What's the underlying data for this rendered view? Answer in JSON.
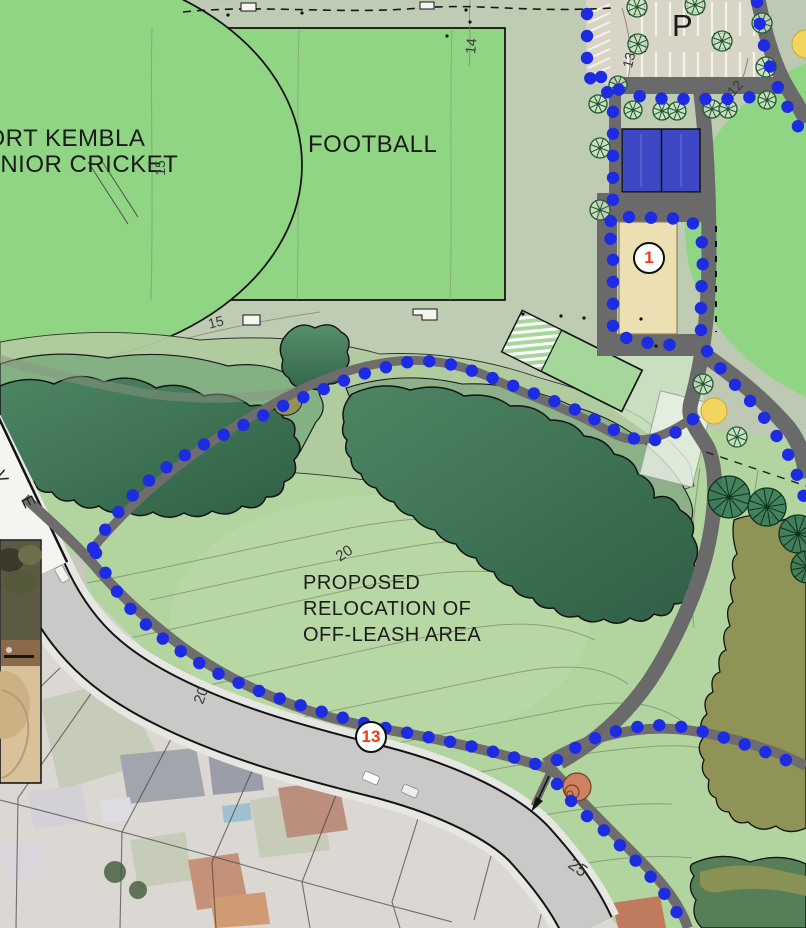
{
  "labels": {
    "oval_label": "PORT KEMBLA\nJUNIOR CRICKET",
    "field_label": "FOOTBALL",
    "parking_label": "P",
    "annotation": "PROPOSED\nRELOCATION OF\nOFF-LEASH AREA"
  },
  "markers": [
    {
      "number": "1",
      "x": 649,
      "y": 258
    },
    {
      "number": "13",
      "x": 371,
      "y": 737
    }
  ],
  "contour_labels": [
    {
      "t": "15",
      "x": 152,
      "y": 160,
      "r": -90,
      "s": 14
    },
    {
      "t": "15",
      "x": 208,
      "y": 314,
      "r": -14,
      "s": 14
    },
    {
      "t": "14",
      "x": 463,
      "y": 38,
      "r": -84,
      "s": 14
    },
    {
      "t": "13",
      "x": 621,
      "y": 52,
      "r": -76,
      "s": 14
    },
    {
      "t": "12",
      "x": 727,
      "y": 80,
      "r": -48,
      "s": 14
    },
    {
      "t": "20",
      "x": 336,
      "y": 545,
      "r": -33,
      "s": 15
    },
    {
      "t": "20",
      "x": 193,
      "y": 687,
      "r": -70,
      "s": 15
    },
    {
      "t": "25",
      "x": 568,
      "y": 858,
      "r": 35,
      "s": 17
    }
  ],
  "street_name_letters": [
    {
      "t": "V",
      "x": -5,
      "y": 467,
      "r": 64
    },
    {
      "t": "E",
      "x": 22,
      "y": 492,
      "r": 64
    }
  ],
  "colors": {
    "route_dot": "#1d2be3",
    "marker_number": "#f23a10",
    "court_blue": "#3f48c4",
    "building_tan": "#ecdfb2",
    "field_green": "#8fd584",
    "path_grey": "#6a6a6a",
    "canopy_dark": "#3c7354",
    "olive": "#8f9355",
    "yellow_feature": "#f1d55c",
    "terracotta_feature": "#cd8261"
  },
  "route": {
    "dot_spacing": 22,
    "dot_radius": 6.2,
    "chains": [
      [
        [
          587,
          -8
        ],
        [
          587,
          76
        ],
        [
          601,
          86
        ],
        [
          613,
          98
        ],
        [
          613,
          218
        ],
        [
          604,
          230
        ],
        [
          613,
          242
        ],
        [
          613,
          334
        ],
        [
          640,
          342
        ],
        [
          672,
          345
        ]
      ],
      [
        [
          629,
          217
        ],
        [
          689,
          219
        ],
        [
          701,
          232
        ],
        [
          703,
          258
        ],
        [
          701,
          295
        ],
        [
          701,
          332
        ],
        [
          708,
          354
        ],
        [
          722,
          370
        ],
        [
          737,
          387
        ],
        [
          752,
          403
        ],
        [
          766,
          420
        ],
        [
          778,
          438
        ],
        [
          789,
          456
        ],
        [
          797,
          475
        ],
        [
          803,
          494
        ],
        [
          806,
          503
        ]
      ],
      [
        [
          93,
          548
        ],
        [
          111,
          521
        ],
        [
          131,
          497
        ],
        [
          153,
          477
        ],
        [
          178,
          459
        ],
        [
          205,
          444
        ],
        [
          233,
          430
        ],
        [
          262,
          416
        ],
        [
          291,
          402
        ],
        [
          319,
          391
        ],
        [
          348,
          379
        ],
        [
          378,
          369
        ],
        [
          408,
          362
        ],
        [
          438,
          361
        ],
        [
          467,
          369
        ],
        [
          495,
          379
        ],
        [
          522,
          389
        ],
        [
          549,
          399
        ],
        [
          574,
          409
        ],
        [
          598,
          421
        ],
        [
          621,
          434
        ],
        [
          644,
          442
        ],
        [
          666,
          438
        ],
        [
          685,
          427
        ],
        [
          698,
          414
        ]
      ],
      [
        [
          96,
          553
        ],
        [
          108,
          578
        ],
        [
          124,
          602
        ],
        [
          144,
          623
        ],
        [
          167,
          642
        ],
        [
          192,
          659
        ],
        [
          219,
          674
        ],
        [
          248,
          687
        ],
        [
          278,
          698
        ],
        [
          309,
          708
        ],
        [
          340,
          717
        ],
        [
          372,
          725
        ],
        [
          404,
          732
        ],
        [
          437,
          739
        ],
        [
          470,
          746
        ],
        [
          502,
          754
        ],
        [
          530,
          762
        ],
        [
          549,
          769
        ]
      ],
      [
        [
          557,
          784
        ],
        [
          572,
          802
        ],
        [
          589,
          818
        ],
        [
          607,
          833
        ],
        [
          625,
          850
        ],
        [
          642,
          867
        ],
        [
          658,
          885
        ],
        [
          671,
          903
        ],
        [
          682,
          921
        ],
        [
          687,
          928
        ]
      ],
      [
        [
          557,
          760
        ],
        [
          578,
          746
        ],
        [
          602,
          735
        ],
        [
          628,
          728
        ],
        [
          655,
          725
        ],
        [
          682,
          727
        ],
        [
          709,
          733
        ],
        [
          735,
          741
        ],
        [
          760,
          750
        ],
        [
          783,
          759
        ],
        [
          804,
          767
        ]
      ],
      [
        [
          757,
          2
        ],
        [
          760,
          26
        ],
        [
          765,
          50
        ],
        [
          772,
          73
        ],
        [
          781,
          95
        ],
        [
          792,
          115
        ],
        [
          801,
          132
        ]
      ],
      [
        [
          601,
          77
        ],
        [
          613,
          87
        ],
        [
          629,
          94
        ],
        [
          648,
          98
        ],
        [
          669,
          99
        ],
        [
          690,
          99
        ],
        [
          711,
          99
        ],
        [
          732,
          99
        ],
        [
          752,
          97
        ]
      ]
    ]
  },
  "trees": {
    "small": [
      [
        637,
        7,
        10,
        1
      ],
      [
        695,
        5,
        10,
        1
      ],
      [
        638,
        44,
        10,
        1
      ],
      [
        722,
        41,
        10,
        1
      ],
      [
        762,
        23,
        10,
        0
      ],
      [
        766,
        67,
        10,
        0
      ],
      [
        767,
        100,
        9,
        0
      ],
      [
        618,
        85,
        9,
        0
      ],
      [
        598,
        104,
        9,
        0
      ],
      [
        633,
        110,
        9,
        0
      ],
      [
        662,
        111,
        9,
        0
      ],
      [
        677,
        111,
        9,
        0
      ],
      [
        712,
        109,
        9,
        0
      ],
      [
        728,
        109,
        9,
        0
      ],
      [
        600,
        148,
        10,
        0
      ],
      [
        600,
        210,
        10,
        0
      ],
      [
        703,
        384,
        10,
        0
      ],
      [
        737,
        437,
        10,
        0
      ]
    ],
    "palm": [
      [
        729,
        497,
        21
      ],
      [
        767,
        507,
        19
      ],
      [
        798,
        534,
        19
      ],
      [
        807,
        567,
        16
      ]
    ],
    "photo": [
      [
        115,
        872,
        11
      ],
      [
        138,
        890,
        9
      ]
    ]
  }
}
